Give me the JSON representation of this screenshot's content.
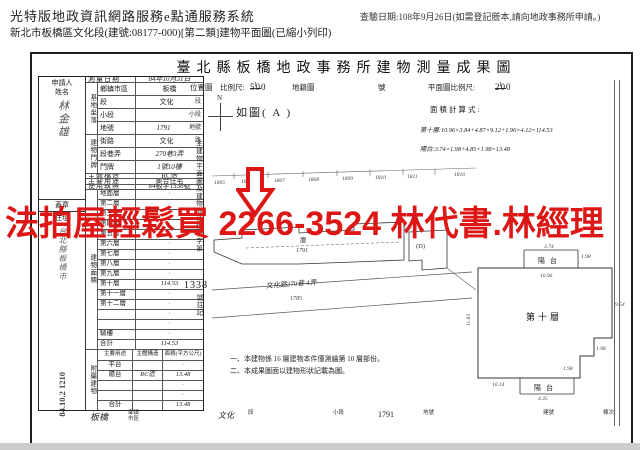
{
  "header": {
    "system_title": "光特版地政資訊網路服務e點通服務系統",
    "doc_line": "新北市板橋區文化段(建號:08177-000)[第二類]建物平面圖(已縮小列印)",
    "query_date": "查驗日期:108年9月26日(如需登記謄本,請向地政事務所申請。)"
  },
  "ad": {
    "text": "法拍屋輕鬆買 2266-3524 林代書.林經理",
    "color": "#dd1715"
  },
  "doc": {
    "title": "臺北縣板橋地政事務所建物測量成果圖"
  },
  "form": {
    "applicant_label1": "申請人",
    "applicant_label2": "姓名",
    "applicant_name": "林金雄",
    "seal": "蓋章",
    "address_label": "住址",
    "address_value": "台北縣板橋市",
    "stamp_text": "84.10.2 1210",
    "survey_label": "測量日期",
    "survey_value": "84年10月31日",
    "site_group": "基地坐落",
    "site_rows": [
      {
        "label": "鄉鎮市區",
        "value": "板橋",
        "suffix": ""
      },
      {
        "label": "段",
        "value": "文化",
        "suffix": "段"
      },
      {
        "label": "小段",
        "value": "",
        "suffix": "小段"
      },
      {
        "label": "地號",
        "value": "1791",
        "suffix": "地號"
      }
    ],
    "door_group": "建物門牌",
    "door_rows": [
      {
        "label": "街路",
        "value": "文化",
        "suffix": "路"
      },
      {
        "label": "段巷弄",
        "value": "270巷3弄",
        "suffix": ""
      },
      {
        "label": "門牌",
        "value": "1號10樓",
        "suffix": ""
      }
    ],
    "struct_label": "主體構造",
    "struct_value": "RC造",
    "use_label": "主要用途",
    "use_value": "集合住宅",
    "license_label": "使用執照",
    "license_value": "84板字1338號",
    "area_group": "建物面積",
    "floors": [
      {
        "label": "地面層",
        "value": "·"
      },
      {
        "label": "第二層",
        "value": "·"
      },
      {
        "label": "第三層",
        "value": "·"
      },
      {
        "label": "第四層",
        "value": "·"
      },
      {
        "label": "第五層",
        "value": "·"
      },
      {
        "label": "第六層",
        "value": "·"
      },
      {
        "label": "第七層",
        "value": "·"
      },
      {
        "label": "第八層",
        "value": "·"
      },
      {
        "label": "第九層",
        "value": "·"
      },
      {
        "label": "第十層",
        "value": "114.53"
      },
      {
        "label": "第十一層",
        "value": "·"
      },
      {
        "label": "第十二層",
        "value": "·"
      },
      {
        "label": "",
        "value": "·"
      },
      {
        "label": "",
        "value": "·"
      },
      {
        "label": "騎樓",
        "value": "·"
      },
      {
        "label": "合計",
        "value": "114.53"
      }
    ],
    "annex_group": "附屬建物",
    "annex_headers": [
      "主要用途",
      "主體構造",
      "面積(平方公尺)"
    ],
    "annex_rows": [
      {
        "use": "平台",
        "structure": "",
        "area": "·"
      },
      {
        "use": "陽台",
        "structure": "RC造",
        "area": "13.48"
      },
      {
        "use": "",
        "structure": "",
        "area": "·"
      },
      {
        "use": "",
        "structure": "",
        "area": "·"
      },
      {
        "use": "合計",
        "structure": "",
        "area": "13.48"
      }
    ]
  },
  "strip": {
    "v1": "板橋",
    "l1a": "鄉鎮",
    "l1b": "市區",
    "v2": "文化",
    "l2": "段",
    "l3": "小段",
    "v4": "1791",
    "l4": "地號",
    "l5": "建號",
    "l6": "棟次"
  },
  "drawing": {
    "loc_label": "位置圖",
    "scale_label": "比例尺:",
    "scale_num": "1",
    "scale_den": "500",
    "cad_label": "地籍圖",
    "no_label": "號",
    "plan_scale_label": "平面圖比例尺:",
    "plan_num": "1",
    "plan_den": "200",
    "north": "N",
    "as_figure": "如圖( A )",
    "calc_title": "面積計算式:",
    "calc_line1": "第十層:10.96×3.84+4.87×9.12+1.96×4.12=114.53",
    "calc_line2": "陽台:3.74×1.98+4.85×1.98=13.48",
    "side_note_a": "主建物平面圖及建物面積係使字第",
    "side_note_num": "1338",
    "side_note_b": "號註記",
    "note1": "一、本建物係 16 層建物本件僅測繪第 10 層部份。",
    "note2": "二、本成果圖面以建物形狀記載為圖。",
    "siteplan": {
      "lots": [
        "1805",
        "1806",
        "1807",
        "1808",
        "1809",
        "1810",
        "1811",
        "1816"
      ],
      "bldg_char": "廈",
      "bldg_parcel": "1791",
      "unit": "(D)",
      "road_text": "文化路270巷 4弄",
      "road_parcel": "1785"
    },
    "floorplan": {
      "label": "第十層",
      "balcony_top": "陽台",
      "balcony_bottom": "陽台",
      "dims": {
        "top": "3.74",
        "top_right": "1.98",
        "under_top": "10.96",
        "left": "11.83",
        "right": "9.54",
        "step": "1.98",
        "notch": "1.98",
        "bottom": "10.14",
        "bottom_balcony": "4.35"
      }
    }
  }
}
